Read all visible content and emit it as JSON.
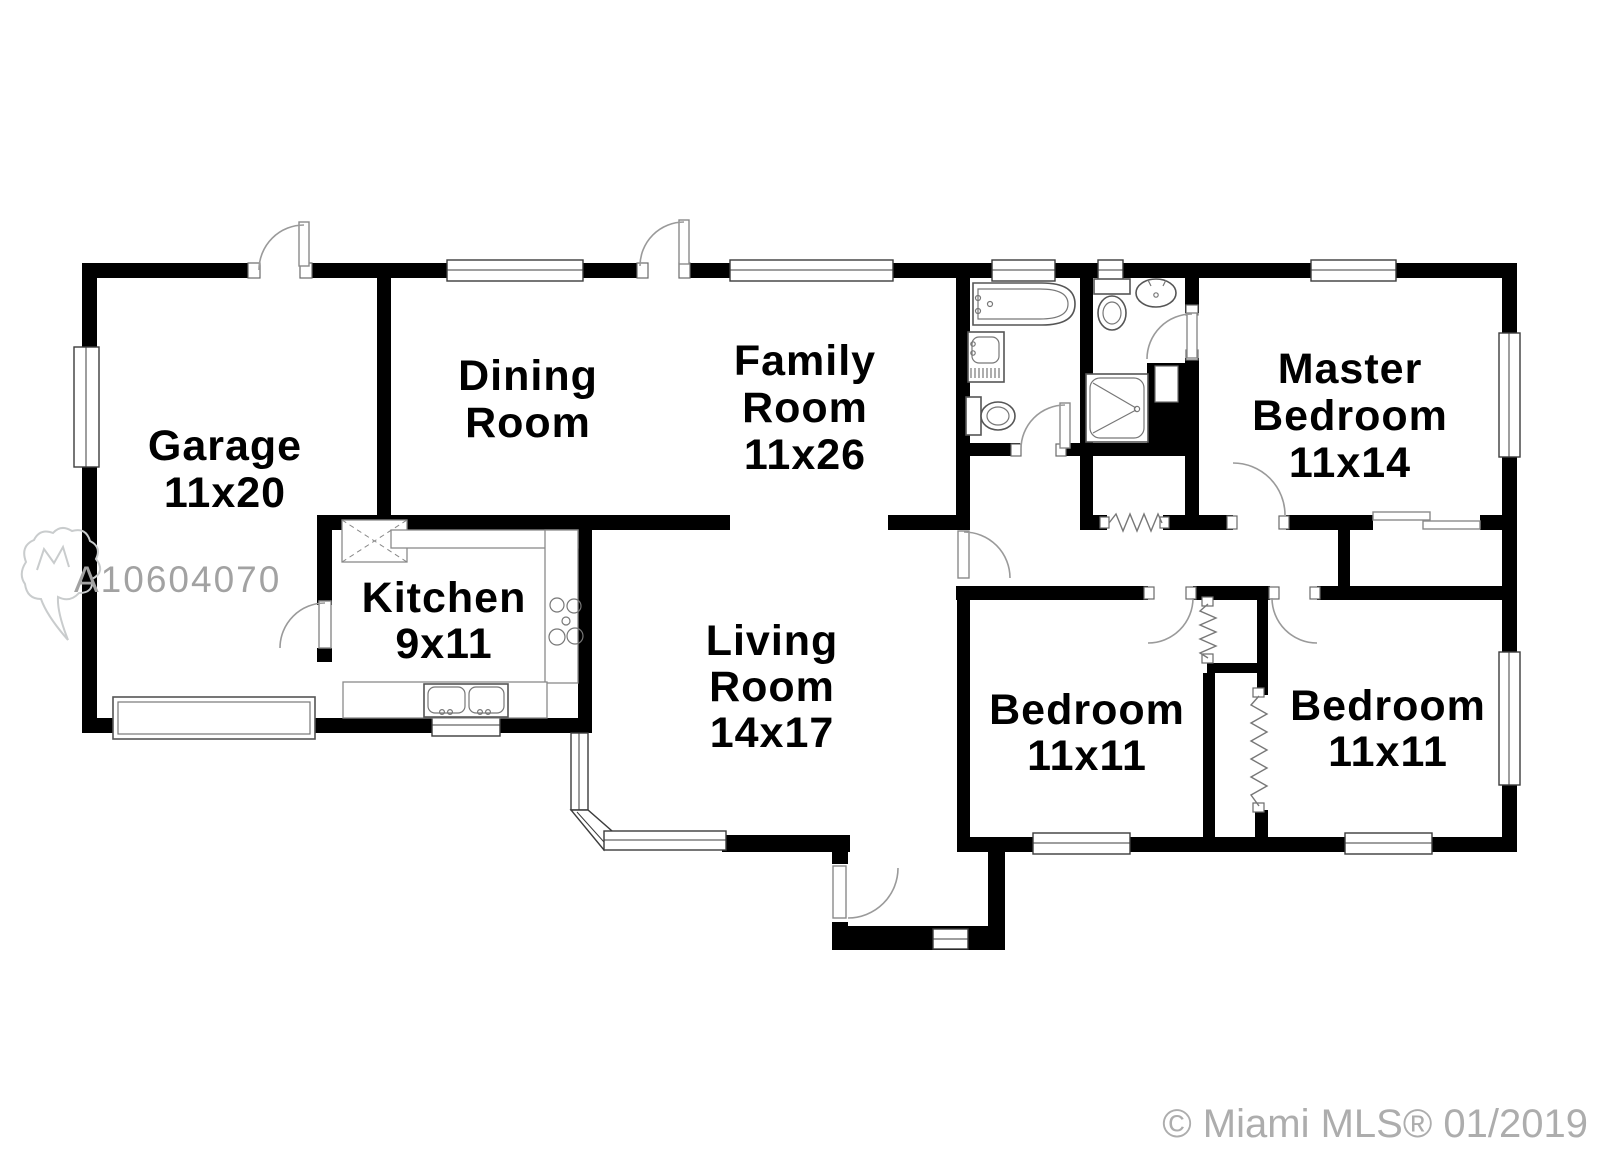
{
  "watermark": {
    "listing_id": "A10604070"
  },
  "footer": {
    "copyright": "© Miami MLS® 01/2019"
  },
  "rooms": {
    "garage": {
      "name": "Garage",
      "size": "11x20"
    },
    "dining": {
      "name_line1": "Dining",
      "name_line2": "Room"
    },
    "family": {
      "name_line1": "Family",
      "name_line2": "Room",
      "size": "11x26"
    },
    "kitchen": {
      "name": "Kitchen",
      "size": "9x11"
    },
    "living": {
      "name_line1": "Living",
      "name_line2": "Room",
      "size": "14x17"
    },
    "master": {
      "name_line1": "Master",
      "name_line2": "Bedroom",
      "size": "11x14"
    },
    "bedroom_left": {
      "name": "Bedroom",
      "size": "11x11"
    },
    "bedroom_right": {
      "name": "Bedroom",
      "size": "11x11"
    }
  }
}
